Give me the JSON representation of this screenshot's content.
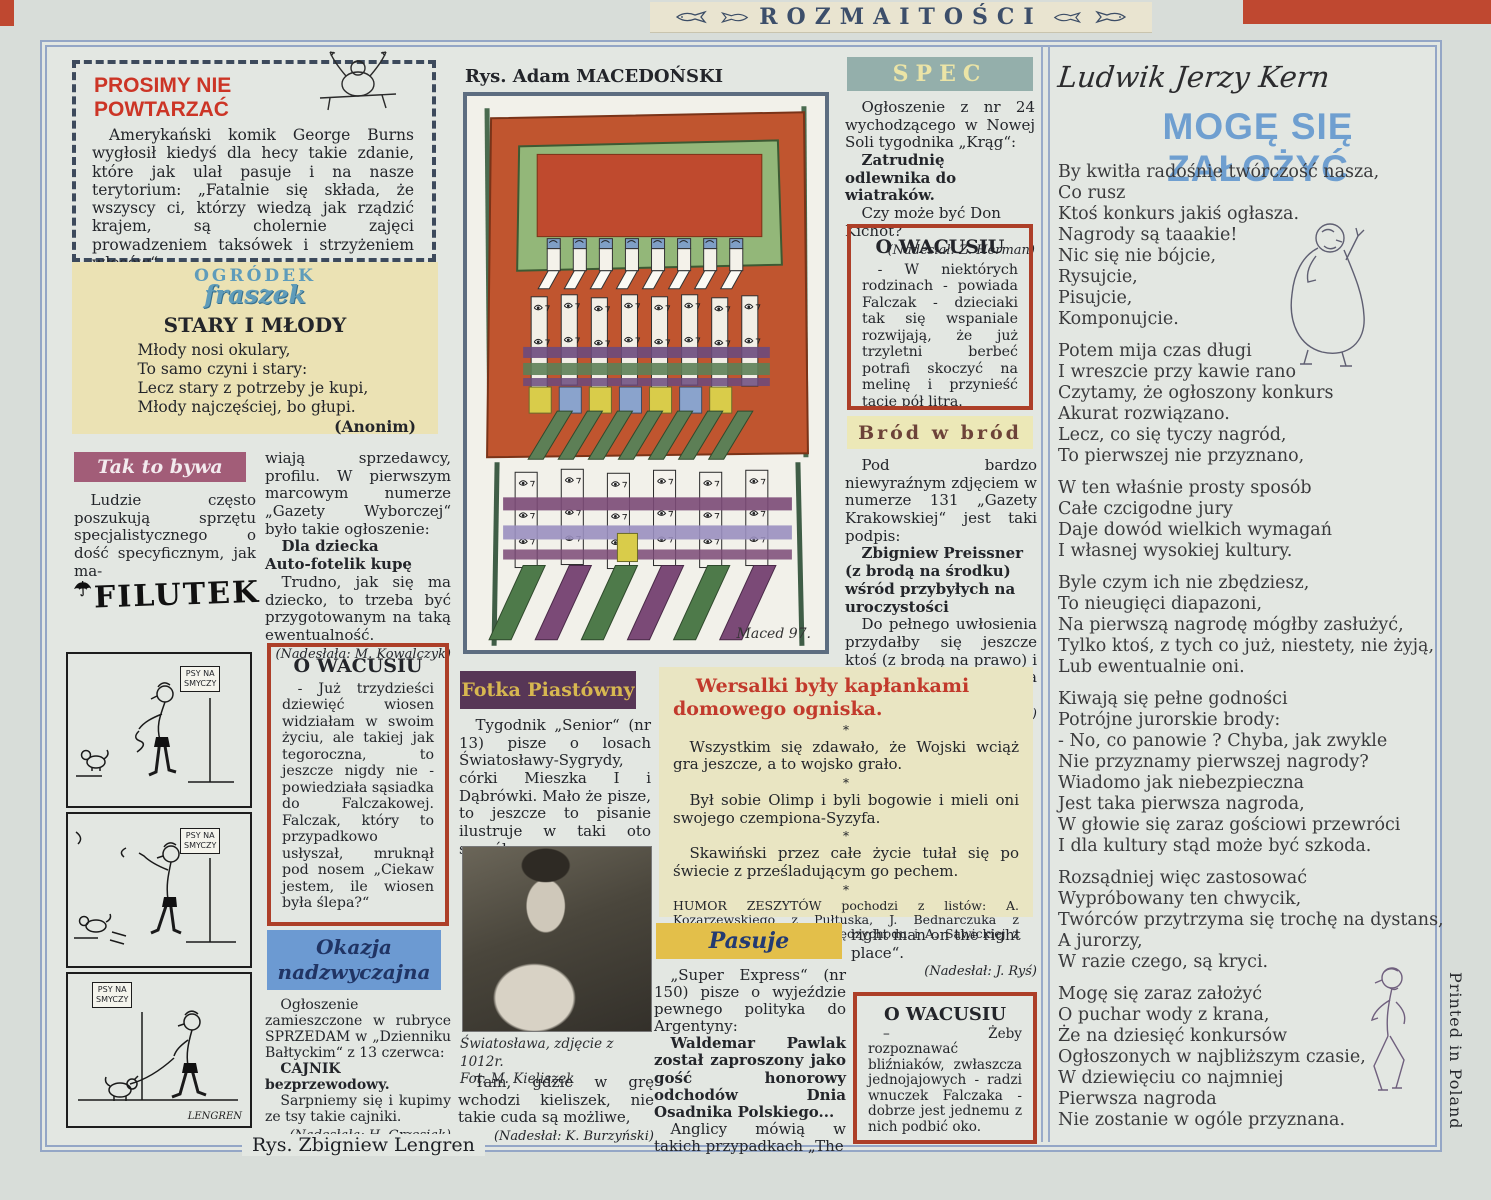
{
  "masthead": {
    "title": "ROZMAITOŚCI"
  },
  "frame": {
    "printed_in": "Printed in Poland",
    "artist_credit": "Rys. Zbigniew Lengren"
  },
  "prosimy": {
    "title": [
      "PROSIMY NIE",
      "POWTARZAĆ"
    ],
    "body": "Amerykański komik George Burns wygłosił kiedyś dla hecy takie zdanie, które jak ulał pasuje i na nasze terytorium: „Fatalnie się składa, że wszyscy ci, którzy wiedzą jak rządzić krajem, są cholernie zajęci prowadzeniem taksówek i strzyżeniem włosów“."
  },
  "fraszka": {
    "logo_top": "OGRÓDEK",
    "logo_bottom": "fraszek",
    "title": "STARY I MŁODY",
    "lines": [
      "Młody nosi okulary,",
      "To samo czyni i stary:",
      "Lecz stary z potrzeby je kupi,",
      "Młody najczęściej, bo głupi."
    ],
    "author": "(Anonim)"
  },
  "tak": {
    "heading": "Tak to bywa",
    "col1": "Ludzie często poszukują sprzętu specjalistycznego o dość specyficznym, jak ma-",
    "col2": "wiają sprzedawcy, profilu. W pierwszym marcowym numerze „Gazety Wyborczej“ było takie ogłoszenie:",
    "ad": [
      "Dla dziecka",
      "Auto-fotelik kupę"
    ],
    "rest": "Trudno, jak się ma dziecko, to trzeba być przygotowanym na taką ewentualność.",
    "credit": "(Nadesłała: M. Kowalczyk)"
  },
  "filutek": {
    "logo": "FILUTEK",
    "sign": [
      "PSY NA",
      "SMYCZY"
    ],
    "signature": "LENGREN"
  },
  "wacusiu1": {
    "heading": "O WACUSIU",
    "body": "- Już trzydzieści dziewięć wiosen widziałam w swoim życiu, ale takiej jak tegoroczna, to jeszcze nigdy nie - powiedziała sąsiadka do Falczakowej. Falczak, który to przypadkowo usłyszał, mruknął pod nosem „Ciekaw jestem, ile wiosen była ślepa?“"
  },
  "okazja": {
    "heading": [
      "Okazja",
      "nadzwyczajna"
    ],
    "intro": "Ogłoszenie zamieszczone w rubryce SPRZEDAM w „Dzienniku Bałtyckim“ z 13 czerwca:",
    "bold": "CAJNIK bezprzewodowy.",
    "rest": "Sarpniemy się i kupimy ze tsy takie cajniki.",
    "credit": "(Nadesłała: H. Grzesiak)"
  },
  "maced": {
    "caption": "Rys. Adam MACEDOŃSKI",
    "signature": "Maced 97."
  },
  "fotka": {
    "heading": "Fotka Piastówny",
    "body": "Tygodnik „Senior“ (nr 13) pisze o losach Światosławy-Sygrydy, córki Mieszka I i Dąbrówki. Mało że pisze, to jeszcze to pisanie ilustruje w taki oto sposób:",
    "photo_caption": [
      "Światosława, zdjęcie z 1012r.",
      "Fot. M. Kieliszek"
    ],
    "after": "Tam, gdzie w grę wchodzi kieliszek, nie takie cuda są możliwe,",
    "credit": "(Nadesłał: K. Burzyński)"
  },
  "spec": {
    "heading": "SPEC",
    "intro": "Ogłoszenie z nr 24 wychodzącego w Nowej Soli tygodnika „Krąg“:",
    "bold": "Zatrudnię odlewnika do wiatraków.",
    "rest": "Czy może być Don Kichot?",
    "credit": "(Nadesłał: Z. Herman)"
  },
  "wacusiu2": {
    "heading": "O WACUSIU",
    "body": "- W niektórych rodzinach - powiada Falczak - dzieciaki tak się wspaniale rozwijają, że już trzyletni berbeć potrafi skoczyć na melinę i przynieść tacie pół litra."
  },
  "brod": {
    "heading": "Bród w bród",
    "intro": "Pod bardzo niewyraźnym zdjęciem w numerze 131 „Gazety Krakowskiej“ jest taki podpis:",
    "bold": "Zbigniew Preissner (z brodą na środku) wśród przybyłych na uroczystości",
    "rest": "Do pełnego uwłosienia przydałby się jeszcze ktoś (z brodą na prawo) i ktoś inny (z brodą na lewo).",
    "credit": "(Nadesłała: D. Sopata)"
  },
  "wersalki": {
    "heading": "Wersalki były kapłankami domowego ogniska.",
    "star": "*",
    "items": [
      "Wszystkim się zdawało, że Wojski wciąż gra jeszcze, a to wojsko grało.",
      "Był sobie Olimp i byli bogowie i mieli oni swojego czempiona-Syzyfa.",
      "Skawiński przez całe życie tułał się po świecie z prześladującym go pechem."
    ],
    "footer": "HUMOR ZESZYTÓW pochodzi z listów: A. Kozarzewskiego z Pułtuska, J. Bednarczuka z Przemyśla, K. Kufel z Międzychodu i A. Sawickiej z Łodzi. Dziękujemy."
  },
  "pasuje": {
    "heading": "Pasuje",
    "p1": "„Super Express“ (nr 150) pisze o wyjeździe pewnego polityka do Argentyny:",
    "bold": "Waldemar Pawlak został zaproszony jako gość honorowy odchodów Dnia Osadnika Polskiego...",
    "p2": "Anglicy mówią w takich przypadkach „The",
    "cont": "right man on the right place“.",
    "credit": "(Nadesłał: J. Ryś)"
  },
  "wacusiu3": {
    "heading": "O WACUSIU",
    "body": "– Żeby rozpoznawać bliźniaków, zwłaszcza jednojajowych - radzi wnuczek Falczaka - dobrze jest jednemu z nich podbić oko."
  },
  "kern": {
    "author": "Ludwik Jerzy Kern",
    "title": "MOGĘ SIĘ ZAŁOŻYĆ",
    "stanzas": [
      [
        "By kwitła radośnie twórczość nasza,",
        "Co rusz",
        "Ktoś konkurs jakiś ogłasza.",
        "Nagrody są taaakie!",
        "Nic się nie bójcie,",
        "Rysujcie,",
        "Pisujcie,",
        "Komponujcie."
      ],
      [
        "Potem mija czas długi",
        "I wreszcie przy kawie rano",
        "Czytamy, że ogłoszony konkurs",
        "Akurat rozwiązano.",
        "Lecz, co się tyczy nagród,",
        "To pierwszej nie przyznano,"
      ],
      [
        "W ten właśnie prosty sposób",
        "Całe czcigodne jury",
        "Daje dowód wielkich wymagań",
        "I własnej wysokiej kultury."
      ],
      [
        "Byle czym ich nie zbędziesz,",
        "To nieugięci diapazoni,",
        "Na pierwszą nagrodę mógłby zasłużyć,",
        "Tylko ktoś, z tych co już, niestety, nie żyją,",
        "Lub ewentualnie oni."
      ],
      [
        "Kiwają się pełne godności",
        "Potrójne jurorskie brody:",
        "- No, co panowie ? Chyba, jak zwykle",
        "Nie przyznamy pierwszej nagrody?",
        "Wiadomo jak niebezpieczna",
        "Jest taka pierwsza nagroda,",
        "W głowie się zaraz gościowi przewróci",
        "I dla kultury stąd może być szkoda."
      ],
      [
        "Rozsądniej więc zastosować",
        "Wypróbowany ten chwycik,",
        "Twórców przytrzyma się trochę na dystans,",
        "A jurorzy,",
        "W razie czego, są kryci."
      ],
      [
        "Mogę się zaraz założyć",
        "O puchar wody z krana,",
        "Że na dziesięć konkursów",
        "Ogłoszonych w najbliższym czasie,",
        "W dziewięciu co najmniej",
        "Pierwsza nagroda",
        "Nie zostanie w ogóle przyznana."
      ]
    ]
  }
}
